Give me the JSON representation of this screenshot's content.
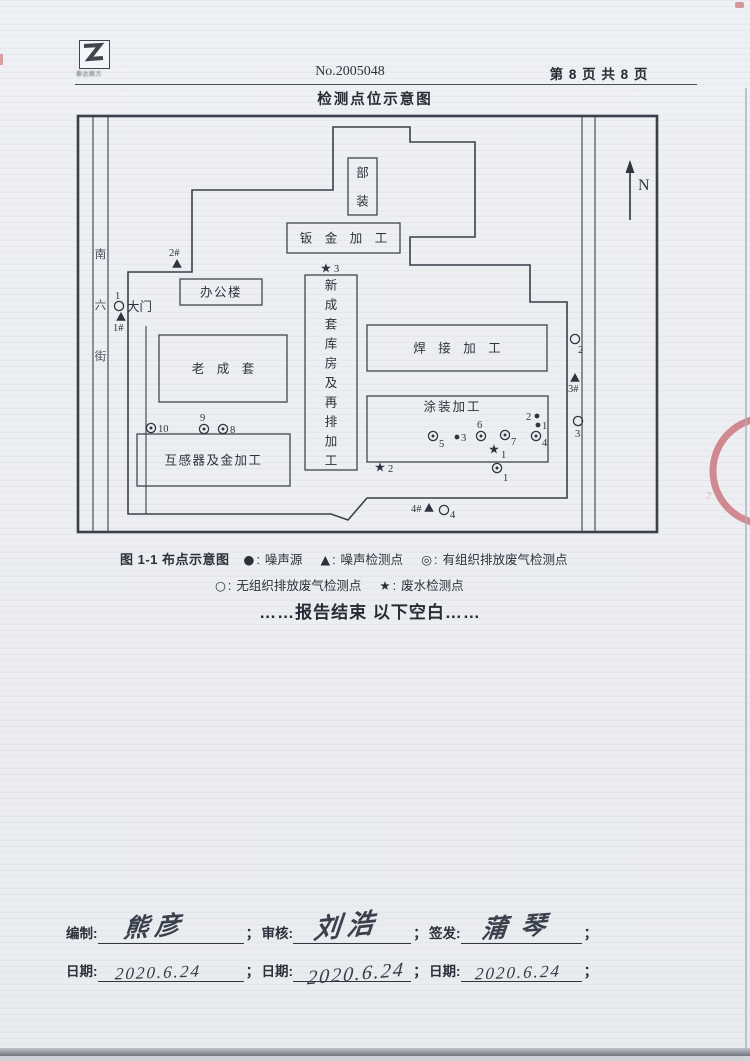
{
  "header": {
    "logo_caption": "泰达图方",
    "report_no": "No.2005048",
    "page_indicator": "第 8 页 共 8 页",
    "title": "检测点位示意图"
  },
  "diagram": {
    "north_label": "N",
    "street_label": "南六街",
    "gate_label": "大门",
    "outer": [
      78,
      116,
      579,
      416
    ],
    "roads": {
      "left": [
        93,
        108
      ],
      "right": [
        582,
        595
      ]
    },
    "boundary": [
      [
        128,
        514
      ],
      [
        128,
        272
      ],
      [
        192,
        272
      ],
      [
        192,
        190
      ],
      [
        333,
        190
      ],
      [
        333,
        127
      ],
      [
        410,
        127
      ],
      [
        410,
        142
      ],
      [
        475,
        142
      ],
      [
        475,
        237
      ],
      [
        410,
        237
      ],
      [
        410,
        265
      ],
      [
        530,
        265
      ],
      [
        530,
        302
      ],
      [
        567,
        302
      ],
      [
        567,
        498
      ],
      [
        367,
        498
      ],
      [
        348,
        520
      ],
      [
        331,
        514
      ]
    ],
    "inner_road": {
      "x": 146,
      "y1": 326,
      "y2": 514
    },
    "buildings": [
      {
        "label": "部装",
        "x": 348,
        "y": 158,
        "w": 29,
        "h": 57,
        "mode": "vertical"
      },
      {
        "label": "钣金加工",
        "x": 287,
        "y": 223,
        "w": 113,
        "h": 30,
        "mode": "spaced"
      },
      {
        "label": "办公楼",
        "x": 180,
        "y": 279,
        "w": 82,
        "h": 26,
        "mode": "plain"
      },
      {
        "label": "老成套",
        "x": 159,
        "y": 335,
        "w": 128,
        "h": 67,
        "mode": "spaced"
      },
      {
        "label": "新成套库房及再排加工",
        "x": 305,
        "y": 275,
        "w": 52,
        "h": 195,
        "mode": "vertical"
      },
      {
        "label": "焊接加工",
        "x": 367,
        "y": 325,
        "w": 180,
        "h": 46,
        "mode": "spaced"
      },
      {
        "label": "涂装加工",
        "x": 367,
        "y": 396,
        "w": 181,
        "h": 66,
        "mode": "top"
      },
      {
        "label": "互感器及金加工",
        "x": 137,
        "y": 434,
        "w": 153,
        "h": 52,
        "mode": "plain"
      }
    ],
    "markers": [
      {
        "t": "triangle",
        "x": 177,
        "y": 264,
        "label": "2#",
        "lx": 169,
        "ly": 256
      },
      {
        "t": "circle",
        "x": 119,
        "y": 306,
        "label": "1",
        "lx": 115,
        "ly": 299
      },
      {
        "t": "triangle",
        "x": 121,
        "y": 317,
        "label": "1#",
        "lx": 113,
        "ly": 331
      },
      {
        "t": "star",
        "x": 326,
        "y": 268,
        "label": "3",
        "lx": 334,
        "ly": 272
      },
      {
        "t": "circle",
        "x": 575,
        "y": 339,
        "label": "2",
        "lx": 578,
        "ly": 353
      },
      {
        "t": "triangle",
        "x": 575,
        "y": 378,
        "label": "3#",
        "lx": 568,
        "ly": 392
      },
      {
        "t": "circle",
        "x": 578,
        "y": 421,
        "label": "3",
        "lx": 575,
        "ly": 437
      },
      {
        "t": "dcircle",
        "x": 151,
        "y": 428,
        "label": "10",
        "lx": 158,
        "ly": 432
      },
      {
        "t": "dcircle",
        "x": 204,
        "y": 429,
        "label": "9",
        "lx": 200,
        "ly": 421
      },
      {
        "t": "dcircle",
        "x": 223,
        "y": 429,
        "label": "8",
        "lx": 230,
        "ly": 433
      },
      {
        "t": "dcircle",
        "x": 433,
        "y": 436,
        "label": "5",
        "lx": 439,
        "ly": 447
      },
      {
        "t": "dot",
        "x": 457,
        "y": 437,
        "label": "3",
        "lx": 461,
        "ly": 441
      },
      {
        "t": "dcircle",
        "x": 481,
        "y": 436,
        "label": "6",
        "lx": 477,
        "ly": 428
      },
      {
        "t": "dcircle",
        "x": 505,
        "y": 435,
        "label": "7",
        "lx": 511,
        "ly": 445
      },
      {
        "t": "star",
        "x": 494,
        "y": 449,
        "label": "1",
        "lx": 501,
        "ly": 458
      },
      {
        "t": "dot",
        "x": 537,
        "y": 416,
        "label": "2",
        "lx": 526,
        "ly": 420
      },
      {
        "t": "dot",
        "x": 538,
        "y": 425,
        "label": "1",
        "lx": 542,
        "ly": 429
      },
      {
        "t": "dcircle",
        "x": 536,
        "y": 436,
        "label": "4",
        "lx": 542,
        "ly": 446
      },
      {
        "t": "dcircle",
        "x": 497,
        "y": 468,
        "label": "1",
        "lx": 503,
        "ly": 481
      },
      {
        "t": "star",
        "x": 380,
        "y": 467,
        "label": "2",
        "lx": 388,
        "ly": 472
      },
      {
        "t": "triangle",
        "x": 429,
        "y": 508,
        "label": "4#",
        "lx": 411,
        "ly": 512
      },
      {
        "t": "circle",
        "x": 444,
        "y": 510,
        "label": "4",
        "lx": 450,
        "ly": 518
      }
    ],
    "north": {
      "x": 630,
      "y_tail": 220,
      "y_head": 160,
      "label_x": 638,
      "label_y": 190
    }
  },
  "legend": {
    "figure_label": "图 1-1 布点示意图",
    "colon": ":",
    "items": [
      {
        "symbol": "●",
        "label": "噪声源",
        "row": 1
      },
      {
        "symbol": "▲",
        "label": "噪声检测点",
        "row": 1
      },
      {
        "symbol": "◎",
        "label": "有组织排放废气检测点",
        "row": 1
      },
      {
        "symbol": "○",
        "label": "无组织排放废气检测点",
        "row": 2
      },
      {
        "symbol": "★",
        "label": "废水检测点",
        "row": 2
      }
    ]
  },
  "end_note": "……报告结束 以下空白……",
  "signoff": {
    "separator": "；",
    "columns": [
      {
        "role_label": "编制:",
        "signature": "熊彦",
        "date_label": "日期:",
        "date": "2020.6.24",
        "line_w": 146
      },
      {
        "role_label": "审核:",
        "signature": "刘浩",
        "date_label": "日期:",
        "date": "2020.6.24",
        "line_w": 118
      },
      {
        "role_label": "签发:",
        "signature": "蒲琴",
        "date_label": "日期:",
        "date": "2020.6.24",
        "line_w": 121
      }
    ]
  }
}
